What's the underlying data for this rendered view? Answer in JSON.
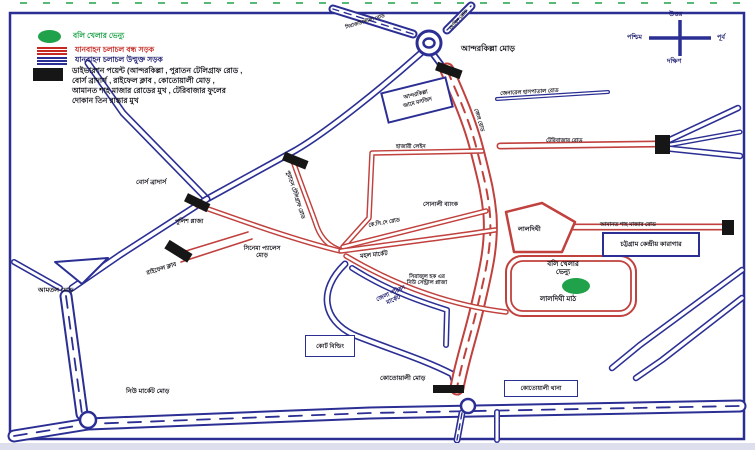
{
  "colors": {
    "road_open_blue": "#2b2f94",
    "road_closed_red": "#c0413d",
    "venue_green": "#1fa24a",
    "diversion_black": "#161616"
  },
  "legend": {
    "venue_label": "বলি খেলার ভেন্যু",
    "closed_label": "যানবাহন চলাচল বন্ধ সড়ক",
    "open_label": "যানবাহন চলাচল উন্মুক্ত সড়ক",
    "diversion_line1": "ডাইভারশন পয়েন্ট (আন্দরকিল্লা , পুরাতন টেলিগ্রাফ রোড ,",
    "diversion_line2": "বোর্স ব্রাদার্স , রাইফেল ক্লাব , কোতোয়ালী মোড় ,",
    "diversion_line3": "আমানত শাহ মাজার রোডের মুখ , টেরিবাজার ফুলের",
    "diversion_line4": "দোকান তিন রাস্তার মুখ"
  },
  "compass": {
    "north": "উত্তর",
    "south": "দক্ষিণ",
    "east": "পূর্ব",
    "west": "পশ্চিম"
  },
  "labels": {
    "andarkilla_mor": "আন্দরকিল্লা মোড়",
    "mosque_l1": "আন্দরকিল্লা",
    "mosque_l2": "জামে মসজিদ",
    "road_nw": "সিরাজউদ্দৌলা রোড",
    "road_ne": "মোমিন রোড",
    "general_hospital_road": "জেনারেল হাসপাতাল রোড",
    "jail_road": "জেল রোড",
    "teribazar_road": "টেরিবাজার রোড",
    "hazari_lane": "হাজারী লেইন",
    "sonali_bank": "সোনালী ব্যাংক",
    "kc_dey_road": "কে.সি.দে রোড",
    "old_telegraph_road": "পুরাতন টেলিগ্রাফ রোড",
    "bors_brothers": "বোর্স ব্রাদার্স",
    "police_plaza": "পুলিশ প্লাজা",
    "cinema_palace_l1": "সিনেমা প্যালেস",
    "cinema_palace_l2": "মোড়",
    "rifle_club": "রাইফেল ক্লাব",
    "amtal_mor": "আমতল মোড়",
    "new_market_mor": "নিউ মার্কেট মোড়",
    "mohol_market": "মহল মার্কেট",
    "sirajul_l1": "সিরাজুল হক এর",
    "sirajul_l2": "নিউ সেন্ট্রাল প্লাজা",
    "jela_parishad_l1": "জেলা পরিষদ",
    "jela_parishad_l2": "মার্কেট",
    "court_building": "কোর্ট বিল্ডিং",
    "kotwali_mor": "কোতোয়ালী মোড়",
    "kotwali_thana": "কোতোয়ালী থানা",
    "laldighi": "লালদিঘী",
    "venue_l1": "বলি খেলার",
    "venue_l2": "ভেন্যু",
    "laldighi_math": "লালদিঘী মাঠ",
    "amanat_shah_road": "আমানত শাহ মাজার রোড",
    "central_jail": "চট্টগ্রাম কেন্দ্রীয় কারাগার"
  }
}
